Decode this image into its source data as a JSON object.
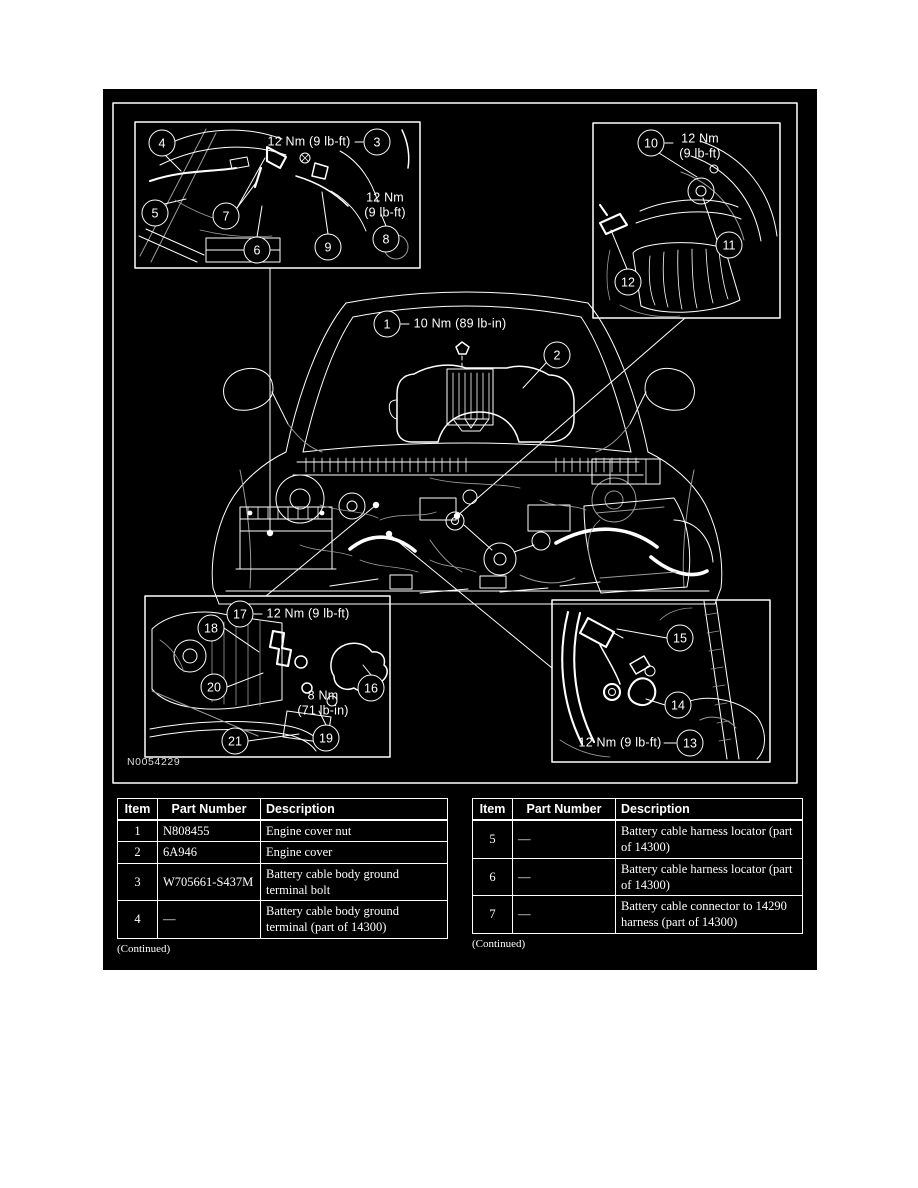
{
  "figure": {
    "id_label": "N0054229",
    "colors": {
      "panel_background": "#000000",
      "line": "#ffffff",
      "page_background": "#ffffff"
    },
    "callouts": [
      {
        "n": "1",
        "x": 387,
        "y": 324
      },
      {
        "n": "2",
        "x": 557,
        "y": 355
      },
      {
        "n": "3",
        "x": 377,
        "y": 142
      },
      {
        "n": "4",
        "x": 162,
        "y": 143
      },
      {
        "n": "5",
        "x": 155,
        "y": 213
      },
      {
        "n": "6",
        "x": 257,
        "y": 250
      },
      {
        "n": "7",
        "x": 226,
        "y": 216
      },
      {
        "n": "8",
        "x": 386,
        "y": 239
      },
      {
        "n": "9",
        "x": 328,
        "y": 247
      },
      {
        "n": "10",
        "x": 651,
        "y": 143
      },
      {
        "n": "11",
        "x": 729,
        "y": 245
      },
      {
        "n": "12",
        "x": 628,
        "y": 282
      },
      {
        "n": "13",
        "x": 690,
        "y": 743
      },
      {
        "n": "14",
        "x": 678,
        "y": 705
      },
      {
        "n": "15",
        "x": 680,
        "y": 638
      },
      {
        "n": "16",
        "x": 371,
        "y": 688
      },
      {
        "n": "17",
        "x": 240,
        "y": 614
      },
      {
        "n": "18",
        "x": 211,
        "y": 628
      },
      {
        "n": "19",
        "x": 326,
        "y": 738
      },
      {
        "n": "20",
        "x": 214,
        "y": 687
      },
      {
        "n": "21",
        "x": 235,
        "y": 741
      }
    ],
    "torque_labels": [
      {
        "lines": [
          "12 Nm (9 lb-ft)"
        ],
        "x": 309,
        "y": 142
      },
      {
        "lines": [
          "12 Nm",
          "(9 lb-ft)"
        ],
        "x": 385,
        "y": 205
      },
      {
        "lines": [
          "12 Nm",
          "(9 lb-ft)"
        ],
        "x": 700,
        "y": 146
      },
      {
        "lines": [
          "10 Nm (89 lb-in)"
        ],
        "x": 460,
        "y": 324
      },
      {
        "lines": [
          "12 Nm (9 lb-ft)"
        ],
        "x": 308,
        "y": 614
      },
      {
        "lines": [
          "8 Nm",
          "(71 lb-in)"
        ],
        "x": 323,
        "y": 703
      },
      {
        "lines": [
          "12 Nm (9 lb-ft)"
        ],
        "x": 620,
        "y": 743
      }
    ]
  },
  "tables": {
    "left": {
      "headers": [
        "Item",
        "Part Number",
        "Description"
      ],
      "rows": [
        [
          "1",
          "N808455",
          "Engine cover nut"
        ],
        [
          "2",
          "6A946",
          "Engine cover"
        ],
        [
          "3",
          "W705661-S437M",
          "Battery cable body ground terminal bolt"
        ],
        [
          "4",
          "—",
          "Battery cable body ground terminal (part of 14300)"
        ]
      ],
      "footer": "(Continued)"
    },
    "right": {
      "headers": [
        "Item",
        "Part Number",
        "Description"
      ],
      "rows": [
        [
          "5",
          "—",
          "Battery cable harness locator (part of 14300)"
        ],
        [
          "6",
          "—",
          "Battery cable harness locator (part of 14300)"
        ],
        [
          "7",
          "—",
          "Battery cable connector to 14290 harness (part of 14300)"
        ]
      ],
      "footer": "(Continued)"
    }
  }
}
